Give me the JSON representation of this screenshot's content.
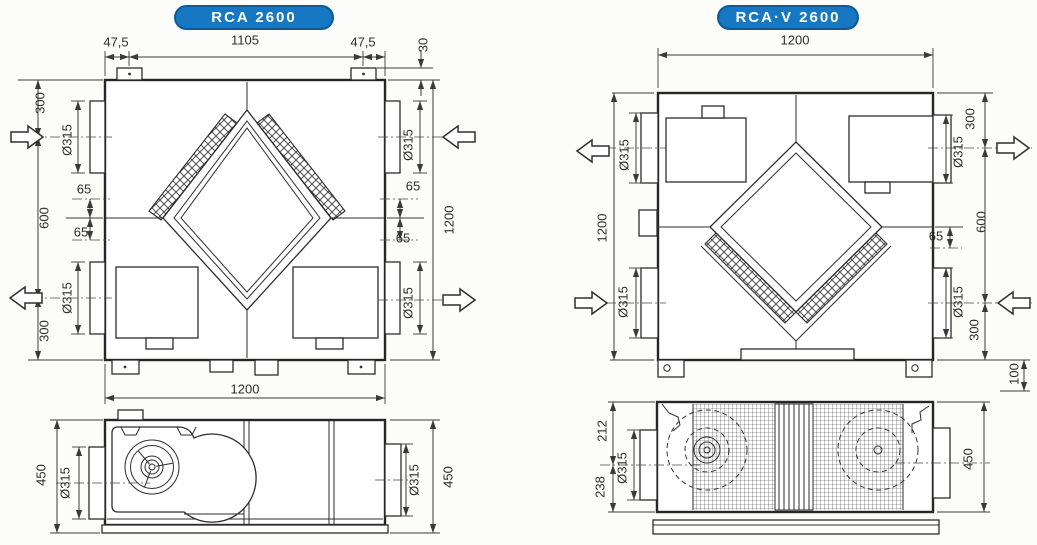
{
  "page": {
    "background": "#fcfcfa",
    "badge_color": "#1677c2"
  },
  "units": {
    "rca": {
      "badge": "RCA 2600",
      "dims": {
        "offset_left": "47,5",
        "top_width": "1105",
        "offset_right": "47,5",
        "tab_height": "30",
        "side_top": "300",
        "side_mid": "600",
        "side_bottom": "300",
        "duct_diameter": "Ø315",
        "duct_offset": "65",
        "overall_height": "1200",
        "overall_width": "1200",
        "depth": "450"
      }
    },
    "rcav": {
      "badge": "RCA·V 2600",
      "dims": {
        "overall_width": "1200",
        "overall_height": "1200",
        "duct_diameter": "Ø315",
        "side_top": "300",
        "side_mid": "600",
        "side_bottom": "300",
        "duct_offset": "65",
        "foot_height": "100",
        "depth": "450",
        "depth_front": "212",
        "depth_back": "238"
      }
    }
  }
}
